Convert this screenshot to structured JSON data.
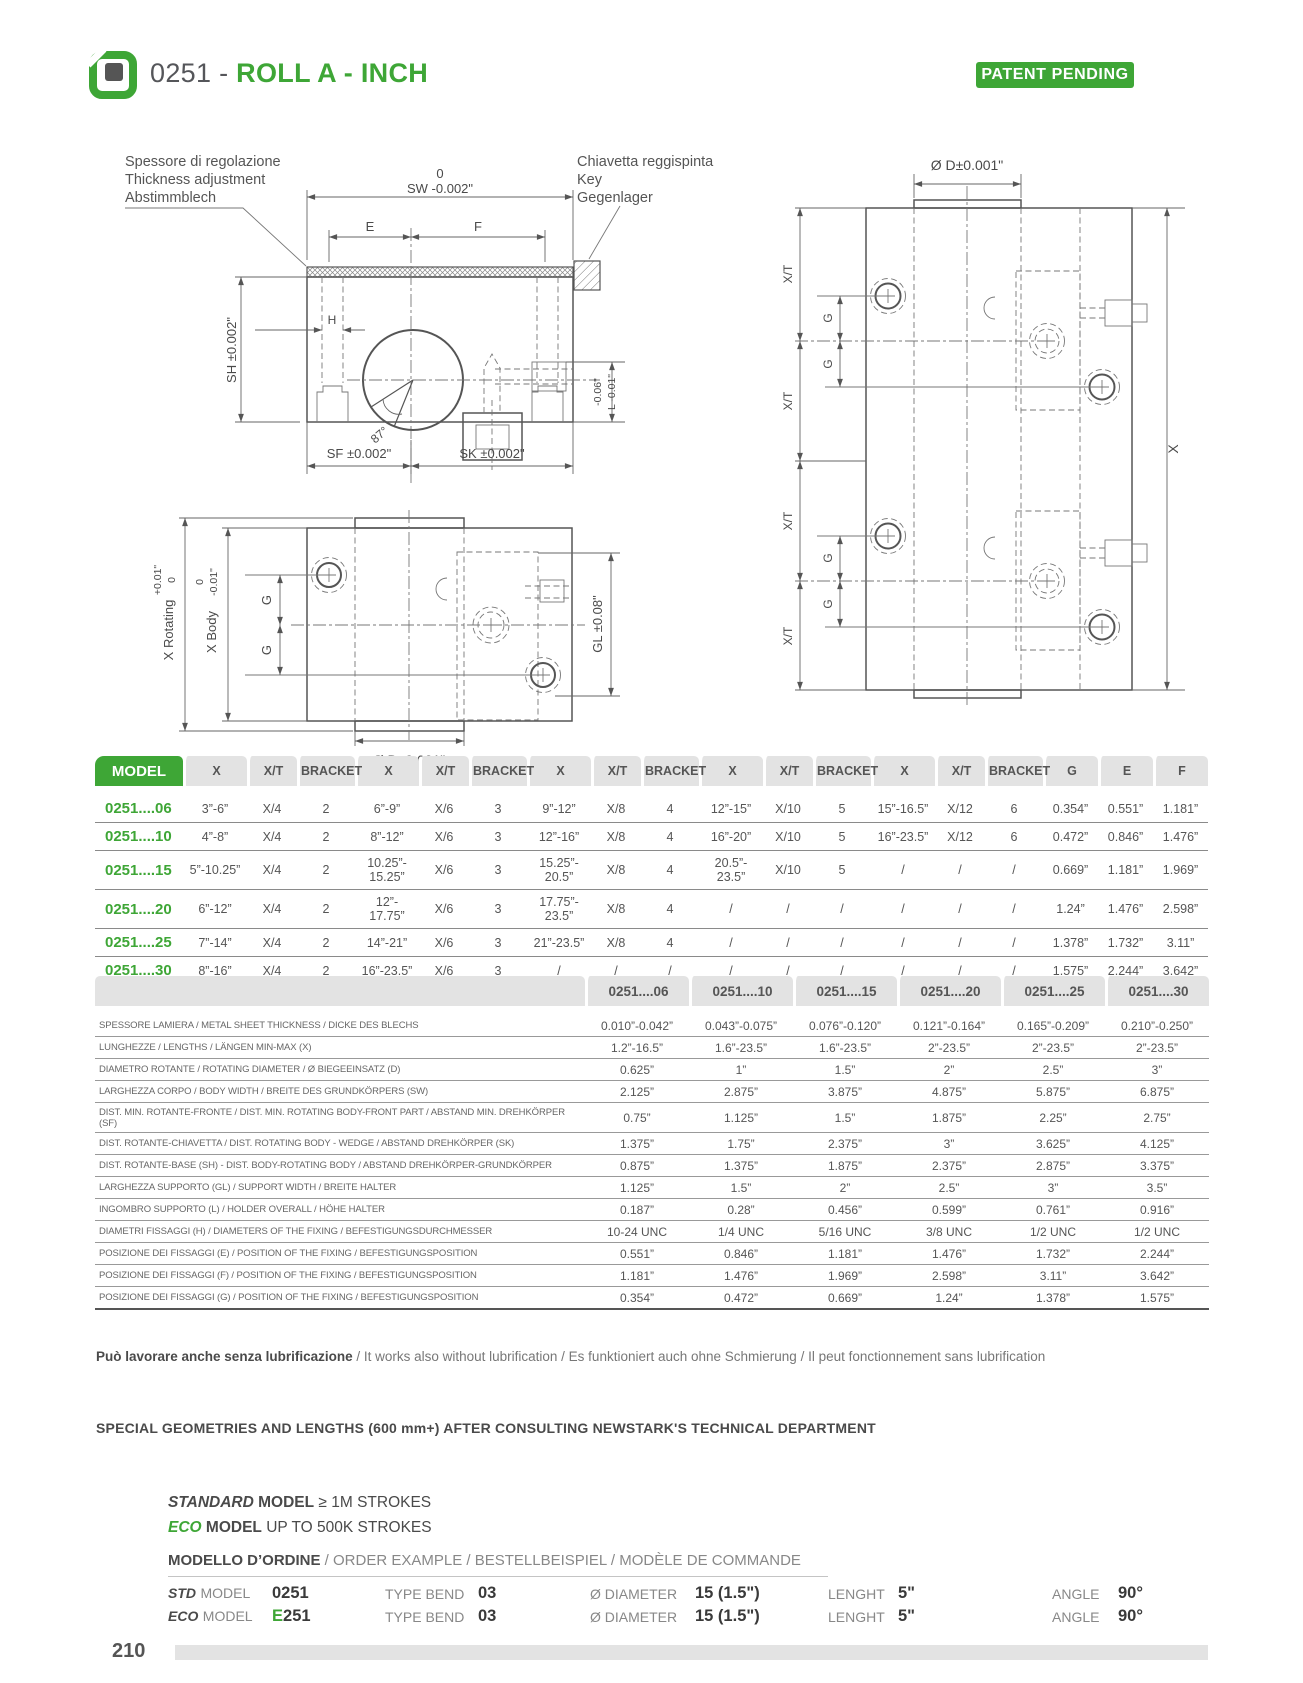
{
  "colors": {
    "accent_green": "#3EA636",
    "text_dark": "#54565A",
    "header_gray": "#e3e3e3"
  },
  "header": {
    "code": "0251 - ",
    "title": "ROLL A - INCH",
    "patent_badge": "PATENT PENDING"
  },
  "drawings": {
    "section": {
      "note_left_1": "Spessore di regolazione",
      "note_left_2": "Thickness adjustment",
      "note_left_3": "Abstimmblech",
      "note_right_1": "Chiavetta reggispinta",
      "note_right_2": "Key",
      "note_right_3": "Gegenlager",
      "dim_sw_zero": "0",
      "dim_sw": "SW -0.002\"",
      "dim_e": "E",
      "dim_f": "F",
      "dim_h": "H",
      "dim_sh": "SH ±0.002\"",
      "dim_l_top": "-0.06\"",
      "dim_l": "L -0.01\"",
      "dim_angle": "87°",
      "dim_sf": "SF ±0.002\"",
      "dim_sk": "SK ±0.002\""
    },
    "plan": {
      "dim_x_rotating": "X Rotating",
      "dim_x_rotating_tol_top": "+0.01\"",
      "dim_x_rotating_tol_bottom": "0",
      "dim_x_body": "X Body",
      "dim_x_body_tol_top": "0",
      "dim_x_body_tol_bottom": "-0.01\"",
      "dim_g": "G",
      "dim_gl": "GL ±0.08\"",
      "dim_d": "Ø D±0.001\""
    },
    "side": {
      "dim_d": "Ø D±0.001\"",
      "dim_xt": "X/T",
      "dim_g": "G",
      "dim_x": "X"
    }
  },
  "models_table": {
    "header": [
      "MODEL",
      "X",
      "X/T",
      "BRACKET",
      "X",
      "X/T",
      "BRACKET",
      "X",
      "X/T",
      "BRACKET",
      "X",
      "X/T",
      "BRACKET",
      "X",
      "X/T",
      "BRACKET",
      "G",
      "E",
      "F"
    ],
    "rows": [
      {
        "label": "0251....06",
        "cells": [
          "3”-6”",
          "X/4",
          "2",
          "6”-9”",
          "X/6",
          "3",
          "9”-12”",
          "X/8",
          "4",
          "12”-15”",
          "X/10",
          "5",
          "15”-16.5”",
          "X/12",
          "6",
          "0.354”",
          "0.551”",
          "1.181”"
        ]
      },
      {
        "label": "0251....10",
        "cells": [
          "4”-8”",
          "X/4",
          "2",
          "8”-12”",
          "X/6",
          "3",
          "12”-16”",
          "X/8",
          "4",
          "16”-20”",
          "X/10",
          "5",
          "16”-23.5”",
          "X/12",
          "6",
          "0.472”",
          "0.846”",
          "1.476”"
        ]
      },
      {
        "label": "0251....15",
        "cells": [
          "5”-10.25”",
          "X/4",
          "2",
          "10.25”-\n15.25”",
          "X/6",
          "3",
          "15.25”-\n20.5”",
          "X/8",
          "4",
          "20.5”-\n23.5”",
          "X/10",
          "5",
          "/",
          "/",
          "/",
          "0.669”",
          "1.181”",
          "1.969”"
        ]
      },
      {
        "label": "0251....20",
        "cells": [
          "6”-12”",
          "X/4",
          "2",
          "12”-\n17.75”",
          "X/6",
          "3",
          "17.75”-\n23.5”",
          "X/8",
          "4",
          "/",
          "/",
          "/",
          "/",
          "/",
          "/",
          "1.24”",
          "1.476”",
          "2.598”"
        ]
      },
      {
        "label": "0251....25",
        "cells": [
          "7”-14”",
          "X/4",
          "2",
          "14”-21”",
          "X/6",
          "3",
          "21”-23.5”",
          "X/8",
          "4",
          "/",
          "/",
          "/",
          "/",
          "/",
          "/",
          "1.378”",
          "1.732”",
          "3.11”"
        ]
      },
      {
        "label": "0251....30",
        "cells": [
          "8”-16”",
          "X/4",
          "2",
          "16”-23.5”",
          "X/6",
          "3",
          "/",
          "/",
          "/",
          "/",
          "/",
          "/",
          "/",
          "/",
          "/",
          "1.575”",
          "2.244”",
          "3.642”"
        ]
      }
    ]
  },
  "specs_table": {
    "header": [
      "",
      "0251....06",
      "0251....10",
      "0251....15",
      "0251....20",
      "0251....25",
      "0251....30"
    ],
    "rows": [
      {
        "label": "SPESSORE LAMIERA / METAL SHEET THICKNESS / DICKE DES BLECHS",
        "cells": [
          "0.010”-0.042”",
          "0.043”-0.075”",
          "0.076”-0.120”",
          "0.121”-0.164”",
          "0.165”-0.209”",
          "0.210”-0.250”"
        ]
      },
      {
        "label": "LUNGHEZZE / LENGTHS / LÄNGEN MIN-MAX (X)",
        "cells": [
          "1.2”-16.5”",
          "1.6”-23.5”",
          "1.6”-23.5”",
          "2”-23.5”",
          "2”-23.5”",
          "2”-23.5”"
        ]
      },
      {
        "label": "DIAMETRO ROTANTE / ROTATING DIAMETER / Ø BIEGEEINSATZ (D)",
        "cells": [
          "0.625”",
          "1”",
          "1.5”",
          "2”",
          "2.5”",
          "3”"
        ]
      },
      {
        "label": "LARGHEZZA CORPO / BODY WIDTH / BREITE DES GRUNDKÖRPERS (SW)",
        "cells": [
          "2.125”",
          "2.875”",
          "3.875”",
          "4.875”",
          "5.875”",
          "6.875”"
        ]
      },
      {
        "label": "DIST. MIN. ROTANTE-FRONTE / DIST. MIN. ROTATING BODY-FRONT PART / ABSTAND MIN. DREHKÖRPER  (SF)",
        "cells": [
          "0.75”",
          "1.125”",
          "1.5”",
          "1.875”",
          "2.25”",
          "2.75”"
        ]
      },
      {
        "label": "DIST. ROTANTE-CHIAVETTA / DIST. ROTATING BODY - WEDGE / ABSTAND DREHKÖRPER (SK)",
        "cells": [
          "1.375”",
          "1.75”",
          "2.375”",
          "3”",
          "3.625”",
          "4.125”"
        ]
      },
      {
        "label": "DIST. ROTANTE-BASE (SH) - DIST. BODY-ROTATING BODY / ABSTAND DREHKÖRPER-GRUNDKÖRPER",
        "cells": [
          "0.875”",
          "1.375”",
          "1.875”",
          "2.375”",
          "2.875”",
          "3.375”"
        ]
      },
      {
        "label": "LARGHEZZA SUPPORTO (GL) / SUPPORT WIDTH / BREITE HALTER",
        "cells": [
          "1.125”",
          "1.5”",
          "2”",
          "2.5”",
          "3”",
          "3.5”"
        ]
      },
      {
        "label": "INGOMBRO SUPPORTO (L) / HOLDER OVERALL / HÖHE HALTER",
        "cells": [
          "0.187”",
          "0.28”",
          "0.456”",
          "0.599”",
          "0.761”",
          "0.916”"
        ]
      },
      {
        "label": "DIAMETRI FISSAGGI (H) / DIAMETERS OF THE FIXING / BEFESTIGUNGSDURCHMESSER",
        "cells": [
          "10-24 UNC",
          "1/4 UNC",
          "5/16 UNC",
          "3/8 UNC",
          "1/2 UNC",
          "1/2 UNC"
        ]
      },
      {
        "label": "POSIZIONE DEI FISSAGGI (E) / POSITION OF THE FIXING / BEFESTIGUNGSPOSITION",
        "cells": [
          "0.551”",
          "0.846”",
          "1.181”",
          "1.476”",
          "1.732”",
          "2.244”"
        ]
      },
      {
        "label": "POSIZIONE DEI FISSAGGI (F) / POSITION OF THE FIXING / BEFESTIGUNGSPOSITION",
        "cells": [
          "1.181”",
          "1.476”",
          "1.969”",
          "2.598”",
          "3.11”",
          "3.642”"
        ]
      },
      {
        "label": "POSIZIONE DEI FISSAGGI (G) / POSITION OF THE FIXING / BEFESTIGUNGSPOSITION",
        "cells": [
          "0.354”",
          "0.472”",
          "0.669”",
          "1.24”",
          "1.378”",
          "1.575”"
        ]
      }
    ]
  },
  "notes": {
    "lubrication_bold": "Può lavorare anche senza lubrificazione",
    "lubrication_rest": " / It works also without lubrification / Es funktioniert auch ohne Schmierung / Il peut fonctionnement sans lubrification",
    "special": "SPECIAL GEOMETRIES AND LENGTHS (600 mm+) AFTER CONSULTING NEWSTARK'S TECHNICAL DEPARTMENT"
  },
  "strokes": {
    "standard_w1": "STANDARD",
    "standard_w2": "MODEL",
    "standard_rest": "≥ 1M STROKES",
    "eco_w1": "ECO",
    "eco_w2": "MODEL",
    "eco_rest": "UP TO 500K STROKES"
  },
  "order": {
    "heading_bold": "MODELLO D’ORDINE",
    "heading_rest": " / ORDER EXAMPLE / BESTELLBEISPIEL / MODÈLE DE COMMANDE",
    "rows": [
      {
        "prefix": "STD",
        "prefix_label": "MODEL",
        "model_green": "",
        "model": "0251",
        "f1": "TYPE BEND",
        "v1": "03",
        "f2": "Ø DIAMETER",
        "v2": "15 (1.5\")",
        "f3": "LENGHT",
        "v3": "5\"",
        "f4": "ANGLE",
        "v4": "90°"
      },
      {
        "prefix": "ECO",
        "prefix_label": "MODEL",
        "model_green": "E",
        "model": "251",
        "f1": "TYPE BEND",
        "v1": "03",
        "f2": "Ø DIAMETER",
        "v2": "15 (1.5\")",
        "f3": "LENGHT",
        "v3": "5\"",
        "f4": "ANGLE",
        "v4": "90°"
      }
    ]
  },
  "footer": {
    "page_number": "210"
  }
}
